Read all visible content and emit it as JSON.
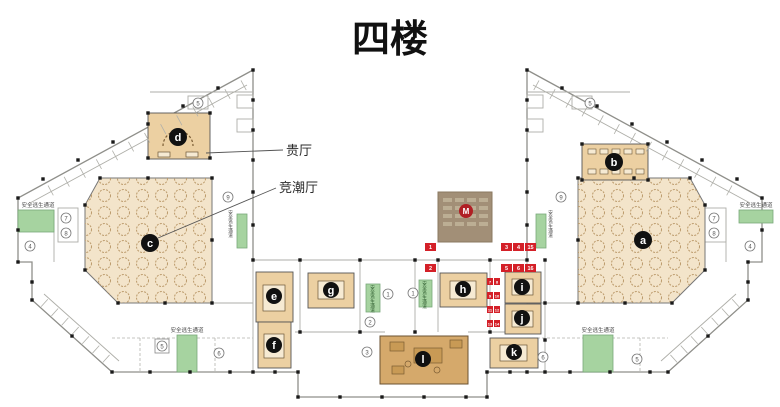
{
  "title": "四楼",
  "callouts": {
    "vip_hall": "贵厅",
    "jingchao_hall": "竞潮厅"
  },
  "escape_label": "安全逃生通道",
  "rooms": {
    "a": "a",
    "b": "b",
    "c": "c",
    "d": "d",
    "e": "e",
    "f": "f",
    "g": "g",
    "h": "h",
    "i": "i",
    "j": "j",
    "k": "k",
    "l": "l",
    "m": "M"
  },
  "red_badges": {
    "b1": "1",
    "b2": "2",
    "b3": "3",
    "b4": "4",
    "b5": "15",
    "b6": "5",
    "b7": "6",
    "b8": "16",
    "strip": [
      "7",
      "8",
      "9",
      "10",
      "11",
      "12",
      "13",
      "14"
    ]
  },
  "circled": [
    "5",
    "9",
    "4",
    "7",
    "8",
    "5",
    "6",
    "1",
    "1",
    "2",
    "3",
    "5",
    "9",
    "7",
    "8",
    "4",
    "6",
    "5"
  ],
  "colors": {
    "accent_red": "#d42028",
    "escape_green": "#a6d3a0",
    "hall_tan": "#f3e4ca",
    "room_tan": "#ecd0a2",
    "room_dark": "#d5a96b",
    "m_box": "#a28f77"
  }
}
